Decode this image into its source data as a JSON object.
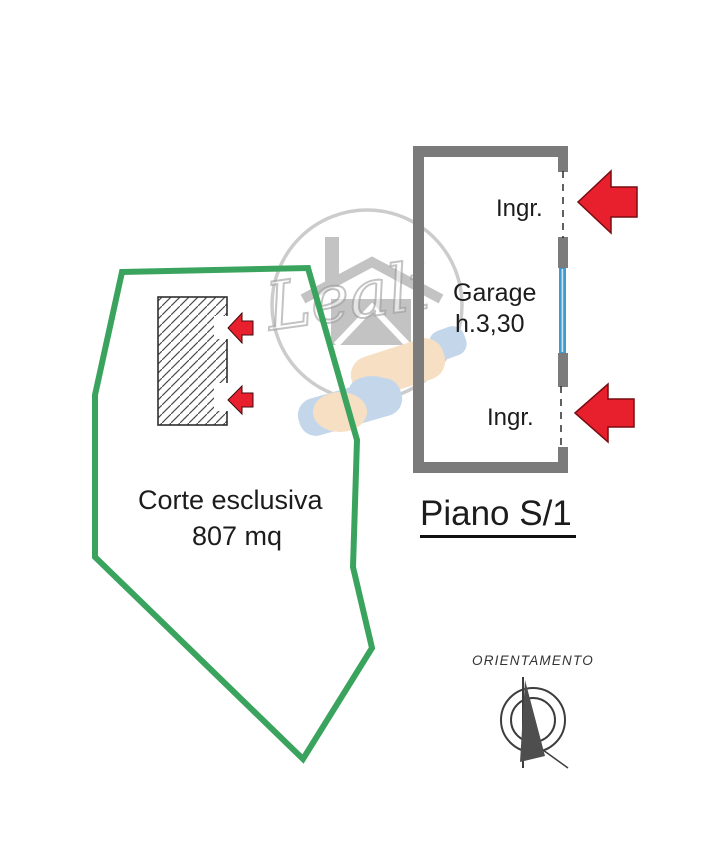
{
  "document": {
    "type": "floor-plan-scan",
    "floor_label": "Piano S/1",
    "orientation_label": "ORIENTAMENTO",
    "watermark_text": "Leali"
  },
  "garage": {
    "name": "Garage",
    "height_note": "h.3,30",
    "entrance_top": "Ingr.",
    "entrance_bottom": "Ingr."
  },
  "courtyard": {
    "label": "Corte esclusiva",
    "area": "807 mq"
  },
  "colors": {
    "boundary_green": "#3aa45e",
    "wall_gray": "#7b7b7b",
    "arrow_red": "#e8202e",
    "window_blue": "#3d9bd1",
    "text": "#1c1c1c",
    "watermark_gray": "#c0c0c0",
    "hand_peach": "#f6d8b6",
    "hand_blue": "#b6cee6"
  }
}
